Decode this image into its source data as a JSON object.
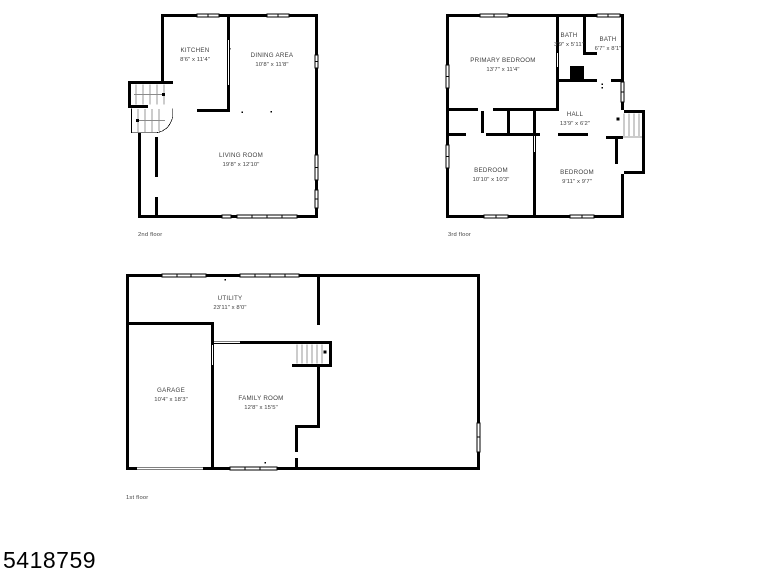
{
  "photo_id": "5418759",
  "colors": {
    "wall": "#000000",
    "label_text": "#3f3f3f",
    "background": "#ffffff"
  },
  "floors": [
    {
      "caption": "2nd floor",
      "rooms": [
        {
          "name": "KITCHEN",
          "dims": "8'6\" x 11'4\""
        },
        {
          "name": "DINING AREA",
          "dims": "10'8\" x 11'8\""
        },
        {
          "name": "LIVING ROOM",
          "dims": "19'8\" x 12'10\""
        }
      ]
    },
    {
      "caption": "3rd floor",
      "rooms": [
        {
          "name": "PRIMARY BEDROOM",
          "dims": "13'7\" x 11'4\""
        },
        {
          "name": "BATH",
          "dims": "3'9\" x 5'11\""
        },
        {
          "name": "BATH",
          "dims": "6'7\" x 8'1\""
        },
        {
          "name": "HALL",
          "dims": "13'9\" x 6'2\""
        },
        {
          "name": "BEDROOM",
          "dims": "10'10\" x 10'3\""
        },
        {
          "name": "BEDROOM",
          "dims": "9'11\" x 9'7\""
        }
      ]
    },
    {
      "caption": "1st floor",
      "rooms": [
        {
          "name": "UTILITY",
          "dims": "23'11\" x 8'0\""
        },
        {
          "name": "GARAGE",
          "dims": "10'4\" x 18'3\""
        },
        {
          "name": "FAMILY ROOM",
          "dims": "12'8\" x 15'5\""
        }
      ]
    }
  ]
}
